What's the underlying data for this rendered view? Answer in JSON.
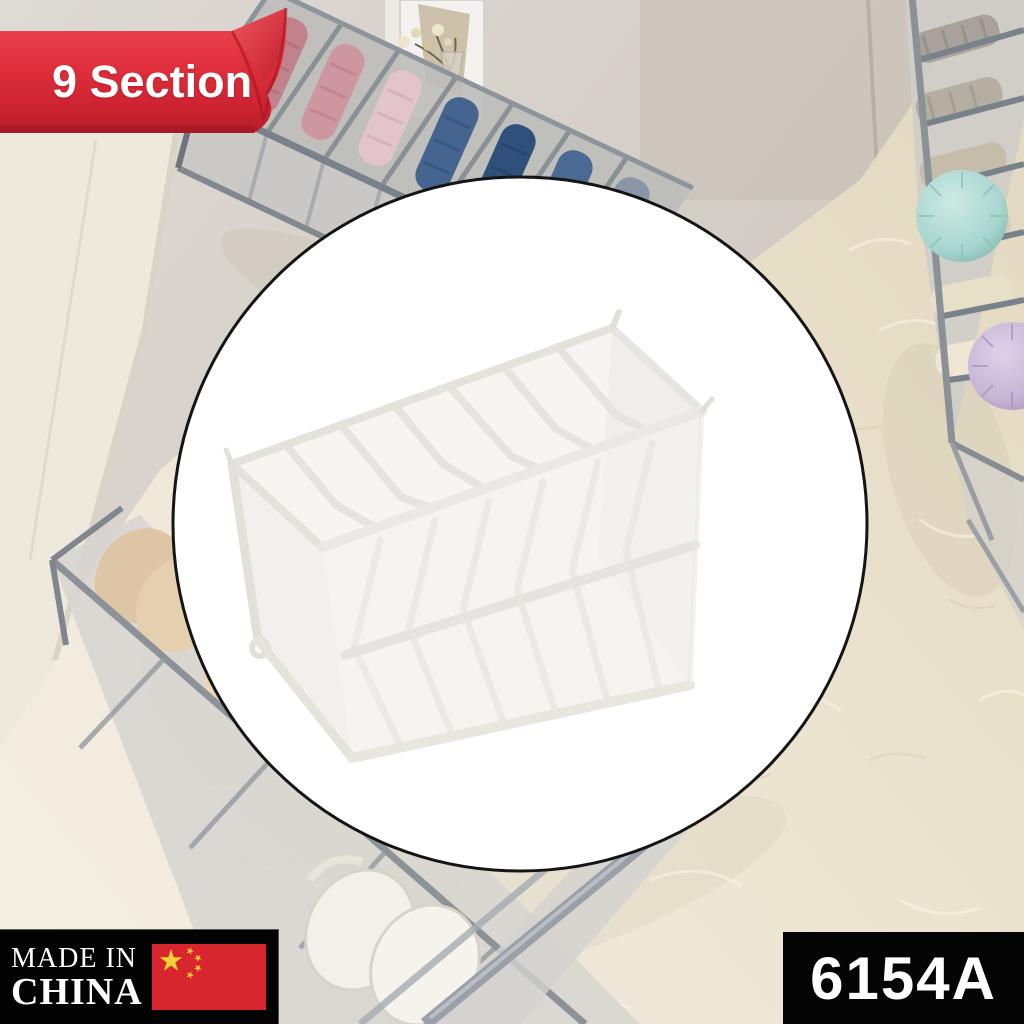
{
  "canvas": {
    "width": 1024,
    "height": 1024
  },
  "overlays": {
    "ribbon": {
      "label": "9 Section",
      "bg_color": "#e0303d",
      "text_color": "#ffffff",
      "style": "page-curl ribbon, top-left"
    },
    "origin_badge": {
      "line1": "MADE IN",
      "line2": "CHINA",
      "bg_color": "#000000",
      "text_color": "#ffffff",
      "flag_icon": "china-flag",
      "flag_field_color": "#d8262e",
      "flag_star_color": "#f7d038"
    },
    "sku_badge": {
      "label": "6154A",
      "bg_color": "#000000",
      "text_color": "#ffffff"
    }
  },
  "hero": {
    "shape": "circle",
    "fill_color": "#ffffff",
    "border_color": "#141414",
    "subject": "white mesh foldable drawer organizer, 7 visible compartments"
  },
  "background_scene": {
    "setting": "closet corner with fluffy cream rug",
    "items": [
      {
        "name": "gray organizer with folded pink and blue clothes",
        "position": "top-left"
      },
      {
        "name": "gray organizer with folded gray and cream clothes",
        "position": "top-right"
      },
      {
        "name": "gray organizer with beige bras",
        "position": "bottom-left"
      },
      {
        "name": "white bra",
        "position": "bottom-center"
      },
      {
        "name": "teal pompom",
        "position": "right",
        "color": "#a7d6cf"
      },
      {
        "name": "lavender pompom",
        "position": "right",
        "color": "#c6b5d5"
      },
      {
        "name": "vase with dried flowers",
        "position": "top-center"
      },
      {
        "name": "white wardrobe panel",
        "position": "left"
      }
    ],
    "wall_color": "#d9d5cf",
    "rug_color": "#ece4d2",
    "organizer_tape_color": "#8b9298",
    "organizer_mesh_color": "#cccbc8"
  }
}
